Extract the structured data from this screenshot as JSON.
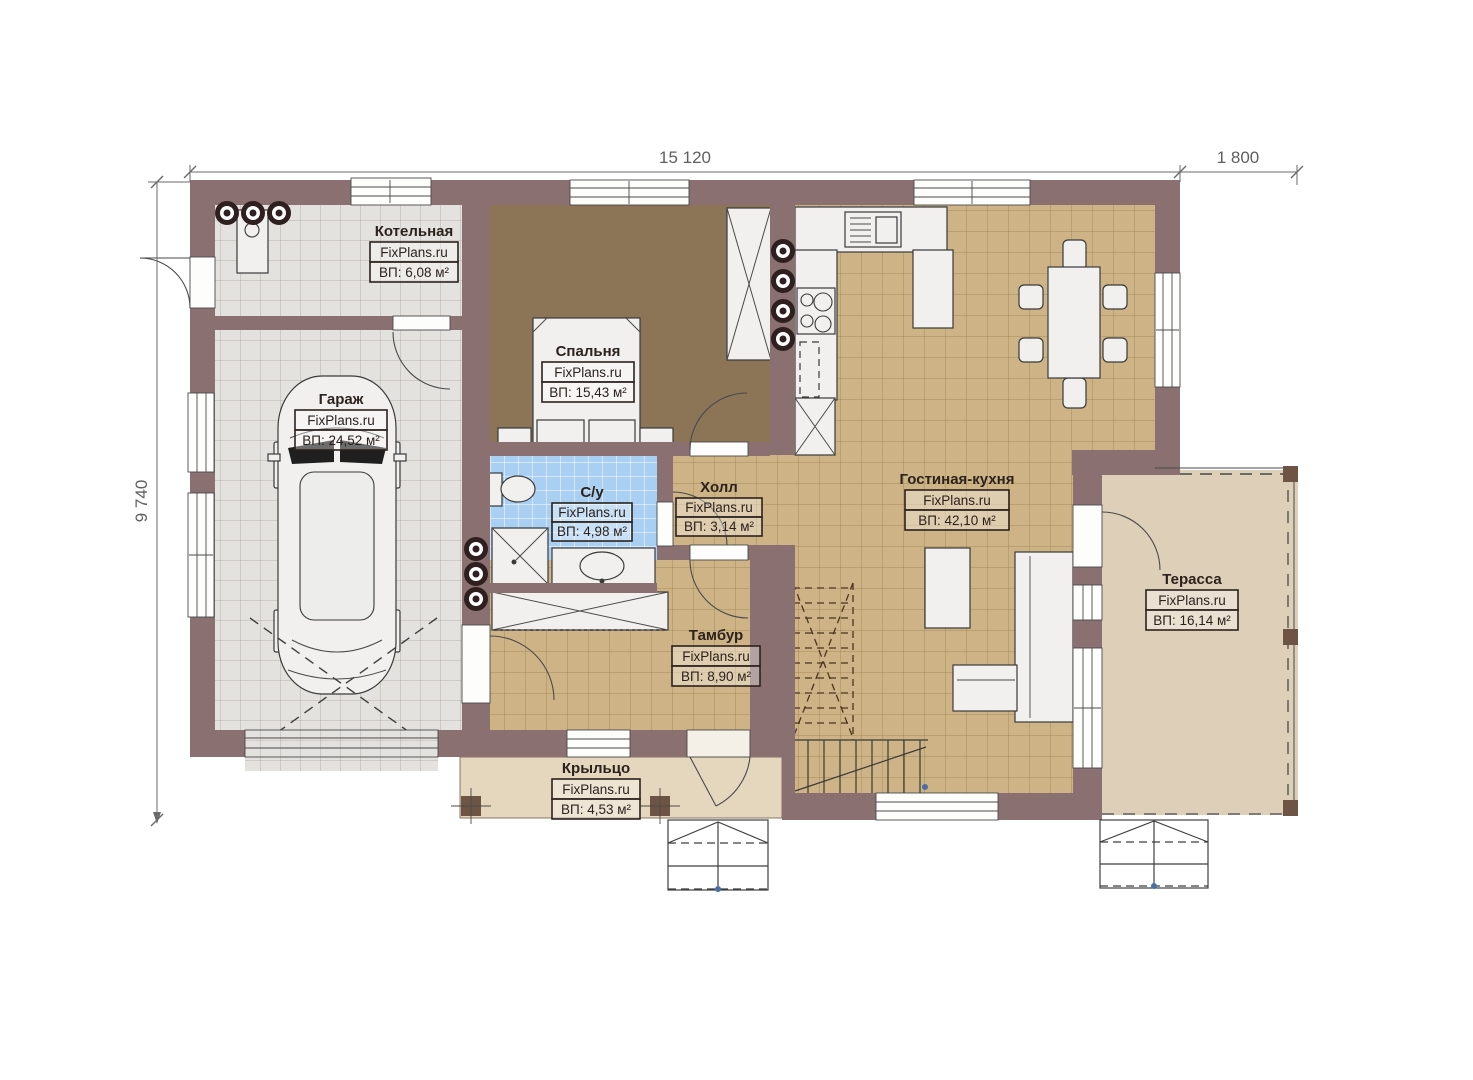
{
  "plan": {
    "site_watermark": "FixPlans.ru",
    "dimensions": {
      "top": "15 120",
      "top_right": "1 800",
      "left": "9 740"
    },
    "rooms": [
      {
        "id": "kotelnaya",
        "name": "Котельная",
        "brand": "FixPlans.ru",
        "area": "ВП: 6,08 м²"
      },
      {
        "id": "garazh",
        "name": "Гараж",
        "brand": "FixPlans.ru",
        "area": "ВП: 24,52 м²"
      },
      {
        "id": "spalnya",
        "name": "Спальня",
        "brand": "FixPlans.ru",
        "area": "ВП: 15,43 м²"
      },
      {
        "id": "su",
        "name": "С/у",
        "brand": "FixPlans.ru",
        "area": "ВП: 4,98 м²"
      },
      {
        "id": "holl",
        "name": "Холл",
        "brand": "FixPlans.ru",
        "area": "ВП: 3,14 м²"
      },
      {
        "id": "gostinaya",
        "name": "Гостиная-кухня",
        "brand": "FixPlans.ru",
        "area": "ВП: 42,10 м²"
      },
      {
        "id": "tambur",
        "name": "Тамбур",
        "brand": "FixPlans.ru",
        "area": "ВП: 8,90 м²"
      },
      {
        "id": "terassa",
        "name": "Терасса",
        "brand": "FixPlans.ru",
        "area": "ВП: 16,14 м²"
      },
      {
        "id": "krylco",
        "name": "Крыльцо",
        "brand": "FixPlans.ru",
        "area": "ВП: 4,53 м²"
      }
    ],
    "colors": {
      "wall": "#8a7071",
      "tile_tan": "#cdb385",
      "tile_gray": "#e4e2de",
      "tile_blue": "#a9cff2",
      "floor_brown": "#8c7456",
      "porch": "#e5d6be",
      "terrace": "#ddcfb8"
    }
  }
}
